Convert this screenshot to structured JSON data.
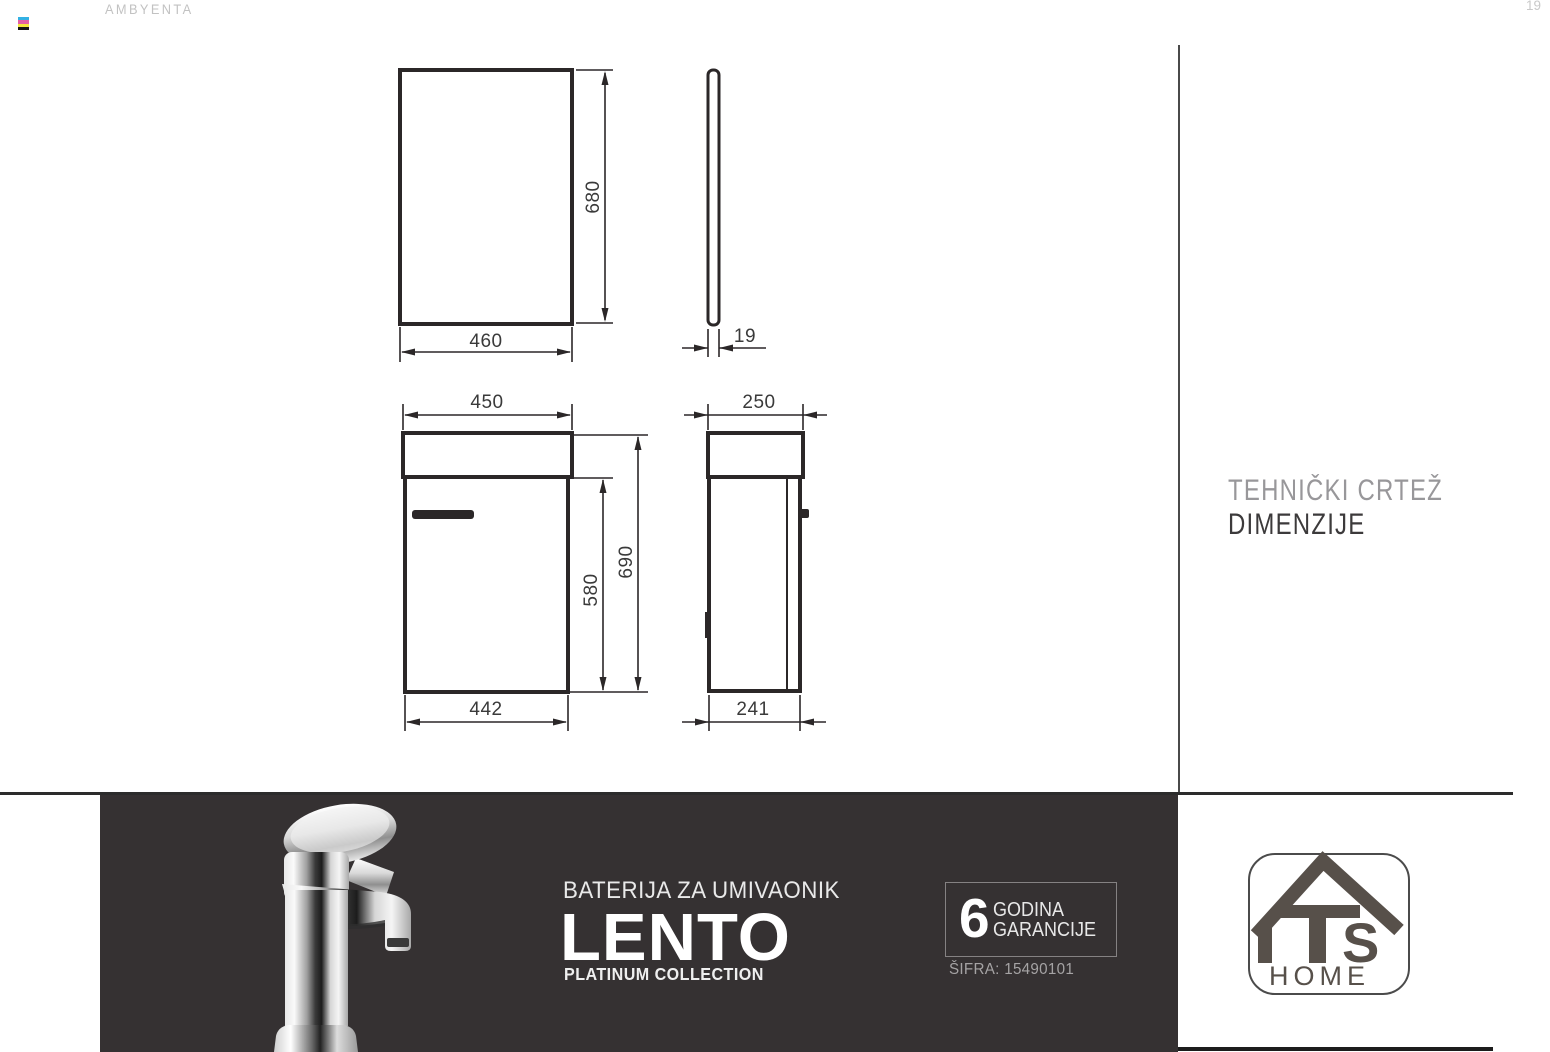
{
  "header": {
    "brand": "AMBYENTA",
    "page_number": "19"
  },
  "right_panel": {
    "line1": "TEHNIČKI CRTEŽ",
    "line2": "DIMENZIJE"
  },
  "dimensions": {
    "mirror_height": "680",
    "mirror_width": "460",
    "mirror_depth": "19",
    "cabinet_top_width": "450",
    "cabinet_side_top_depth": "250",
    "cabinet_door_height": "580",
    "cabinet_total_height": "690",
    "cabinet_bottom_width": "442",
    "cabinet_side_bottom_depth": "241"
  },
  "banner": {
    "category": "BATERIJA ZA UMIVAONIK",
    "product_name": "LENTO",
    "collection": "PLATINUM COLLECTION",
    "warranty_years": "6",
    "warranty_line1": "GODINA",
    "warranty_line2": "GARANCIJE",
    "product_code": "ŠIFRA: 15490101"
  },
  "logo": {
    "letter_s": "S",
    "home": "HOME"
  },
  "colors": {
    "banner-bg": "#353132",
    "line": "#2b2728",
    "dim-text": "#3a3a3a",
    "muted": "#c2c2c2",
    "logo-brown": "#57504a",
    "banner-text": "#f2f2f2"
  }
}
